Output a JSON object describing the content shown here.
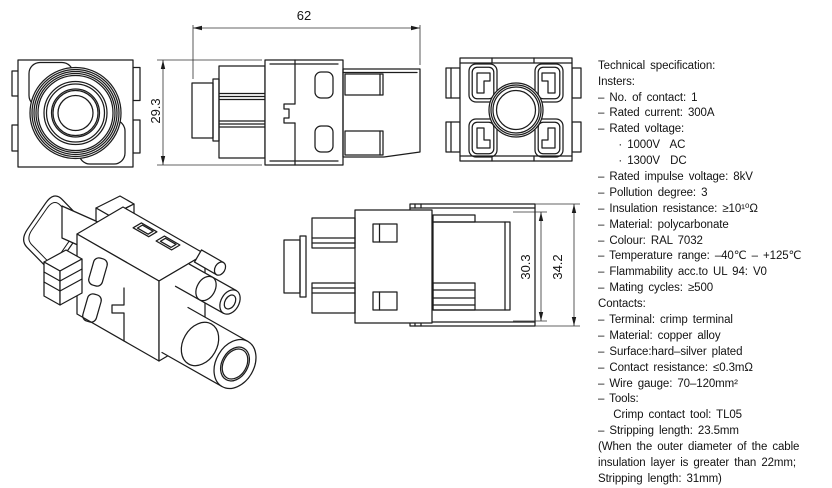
{
  "dimensions": {
    "width": "62",
    "height": "29.3",
    "inner_height": "30.3",
    "outer_height": "34.2"
  },
  "specifications": {
    "lines": [
      "Technical specification:",
      "Insters:",
      "– No. of contact: 1",
      "– Rated current: 300A",
      "– Rated voltage:",
      "    · 1000V  AC",
      "    · 1300V  DC",
      "– Rated impulse voltage: 8kV",
      "– Pollution degree: 3",
      "– Insulation resistance: ≥10¹⁰Ω",
      "– Material: polycarbonate",
      "– Colour: RAL 7032",
      "– Temperature range: –40℃ – +125℃",
      "– Flammability acc.to UL 94: V0",
      "– Mating cycles: ≥500",
      "Contacts:",
      "– Terminal: crimp terminal",
      "– Material: copper alloy",
      "– Surface:hard–silver plated",
      "– Contact resistance: ≤0.3mΩ",
      "– Wire gauge: 70–120mm²",
      "– Tools:",
      "   Crimp contact tool: TL05",
      "– Stripping length: 23.5mm",
      "(When the outer diameter of the cable",
      "insulation layer is greater than 22mm;",
      "Stripping length: 31mm)"
    ]
  },
  "colors": {
    "line": "#1c1c1c",
    "background": "#ffffff"
  }
}
